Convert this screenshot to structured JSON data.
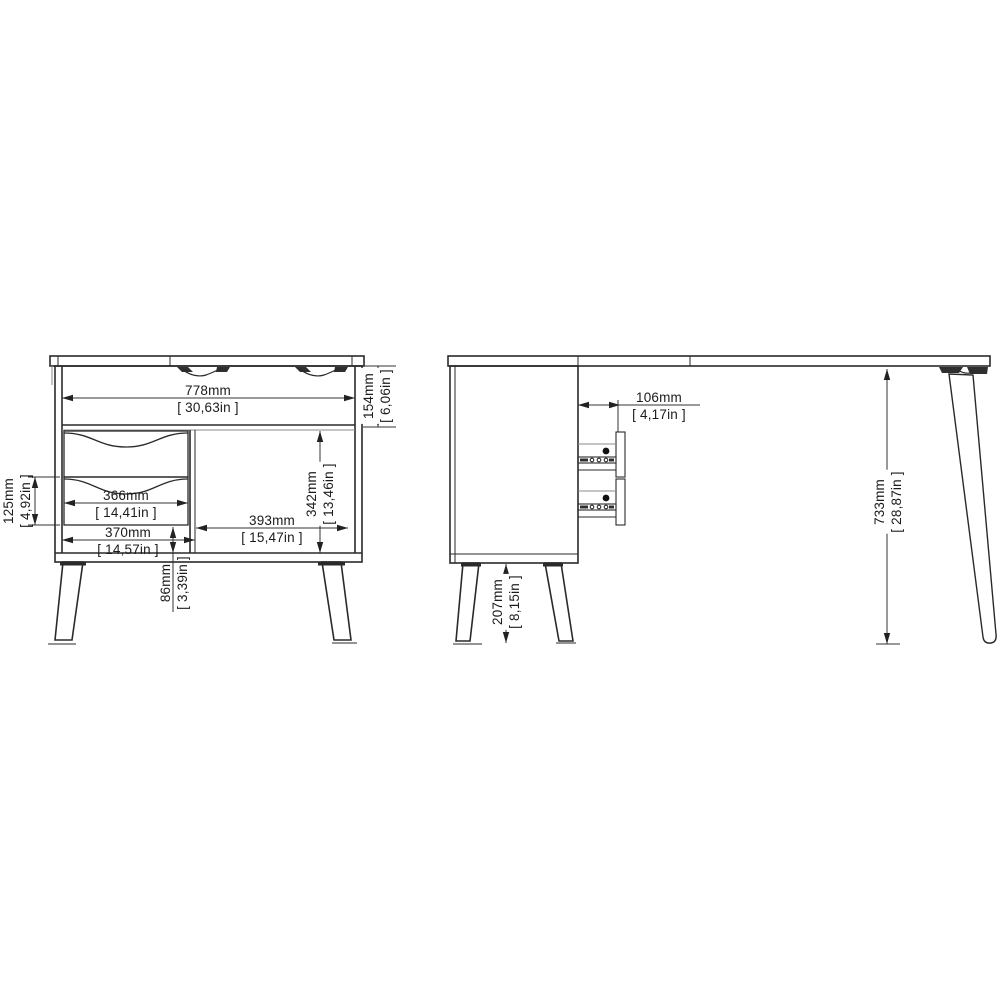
{
  "drawing": {
    "background": "#ffffff",
    "line_color": "#2a2a2a",
    "views": {
      "front": {
        "name": "front-view-cabinet-with-drawers",
        "dims": {
          "width": {
            "mm": "778mm",
            "in": "[ 30,63in ]"
          },
          "top_section_height": {
            "mm": "154mm",
            "in": "[ 6,06in ]"
          },
          "drawer_width": {
            "mm": "366mm",
            "in": "[ 14,41in ]"
          },
          "drawer_height": {
            "mm": "125mm",
            "in": "[ 4,92in ]"
          },
          "opening_width": {
            "mm": "370mm",
            "in": "[ 14,57in ]"
          },
          "compartment_height": {
            "mm": "342mm",
            "in": "[ 13,46in ]"
          },
          "compartment_width": {
            "mm": "393mm",
            "in": "[ 15,47in ]"
          },
          "under_drawer_clearance": {
            "mm": "86mm",
            "in": "[ 3,39in ]"
          }
        }
      },
      "side": {
        "name": "side-view-desk",
        "dims": {
          "drawer_inset": {
            "mm": "106mm",
            "in": "[ 4,17in ]"
          },
          "desk_height": {
            "mm": "733mm",
            "in": "[ 28,87in ]"
          },
          "leg_height": {
            "mm": "207mm",
            "in": "[ 8,15in ]"
          }
        }
      }
    }
  }
}
